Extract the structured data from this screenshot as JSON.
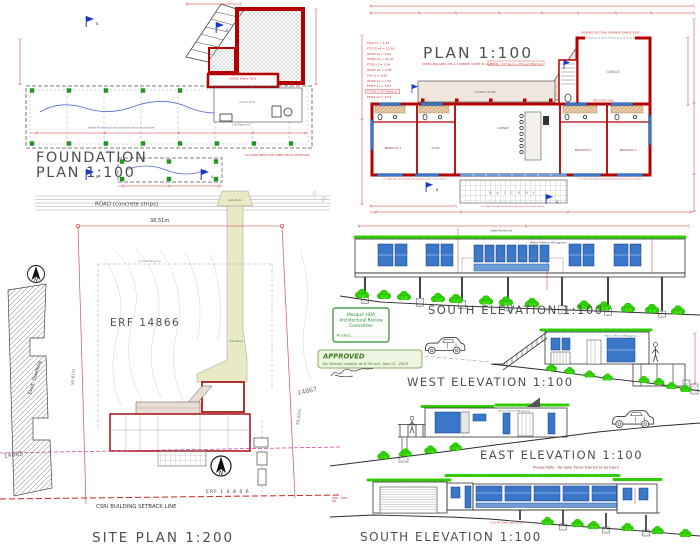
{
  "colors": {
    "wall_red": "#b40000",
    "dim_red": "#cc3333",
    "window_blue": "#3a77c8",
    "vegetation_green": "#2ecc00",
    "stamp_green": "#2e8b2e",
    "driveway_khaki": "#e9e9c5"
  },
  "foundation_plan": {
    "title_line1": "FOUNDATION",
    "title_line2": "PLAN 1:100",
    "water_tank_label": "5000L Water Tank",
    "court_yard_label": "Court Yard",
    "retaining_wall_note": "1.8m Retain wall",
    "plumbing_note": "Sewer Plumbing to be positioned as far as possible",
    "downpipes_note": "ALL DOWN PIPES TO BE CONNECTED TO WATER TANK",
    "section_a": "A",
    "section_b": "B"
  },
  "floor_plan": {
    "title": "PLAN 1:100",
    "area_note": "DWELLING AREA 236 + COVERED STOEP 41 sq.m",
    "area_note_boxed": "TOTAL : 277 sq.m + 35 sq.m Balcony",
    "schedule": [
      "FW2 x1 = 1,44",
      "FTD70 x4 = 22,68",
      "W450 x1 = 6,42",
      "W300 x4 = 21,70",
      "FT28 x2 = 1,94",
      "W240 x2 = 9,38",
      "FW x1 = 0,81",
      "W160 x1 = 1,62",
      "FTW2 x1 = 3,84",
      "TOTAL = 82,56sq.m",
      "FTW1 x2 = 2,52"
    ],
    "garage_door_note": "UPGRADED SECTIONAL OVERHEAD GARAGE DOOR",
    "fire_door_note": "FIRE DOOR & WALL",
    "covered_stoep_label": "COVERED STOEP",
    "balcony_label": "B A L C O N Y",
    "balustrade_note": "1m High Glass Balustrade with openings of less than 100mm",
    "rooms": {
      "bedroom1": "BEDROOM 1",
      "study": "STUDY",
      "lounge": "LOUNGE",
      "garage": "GARAGE",
      "bedroom2": "BEDROOM 2",
      "bedroom3": "BEDROOM 3"
    }
  },
  "site_plan": {
    "title": "SITE PLAN 1:200",
    "road_label": "ROAD (concrete strips)",
    "road_dim": "38,51m",
    "erf_label": "ERF 14866",
    "erf_label_small": "ERF 1 4 8 6 6",
    "setback_label": "CSRI BUILDING SETBACK LINE",
    "building_line_label": "1.6m Building line",
    "west_boundary_dim": "93,61m",
    "east_boundary_dim": "93,02m",
    "neighbor_south": "14865",
    "neighbor_north": "14867",
    "existing_dwelling_label": "Exist. Dwelling",
    "driveway_label": "Grass Blocks",
    "north_letter": "N",
    "contour_label_a": "35",
    "contour_label_b": "90"
  },
  "elevations": {
    "roof_note": "Grass Planted roof",
    "paint_note": "Plaster & Paint to HOA approval",
    "south_upper_title": "SOUTH ELEVATION 1:100",
    "west_title": "WEST ELEVATION 1:100",
    "east_title": "EAST ELEVATION 1:100",
    "solar_note": "Please Note : All Solar Panel Frames to be black",
    "south_lower_title": "SOUTH ELEVATION 1:100",
    "pipe_note": "±110 PVC Sewer pipe 1:60 fall"
  },
  "hoa_box": {
    "line1": "Mosquit HOA",
    "line2": "Architectural Review",
    "line3": "Committee",
    "trustee_label": "Trustee:"
  },
  "approval": {
    "title": "APPROVED",
    "byline": "By Marais Visagie at 8:30 pm, Sep 21, 2023"
  }
}
